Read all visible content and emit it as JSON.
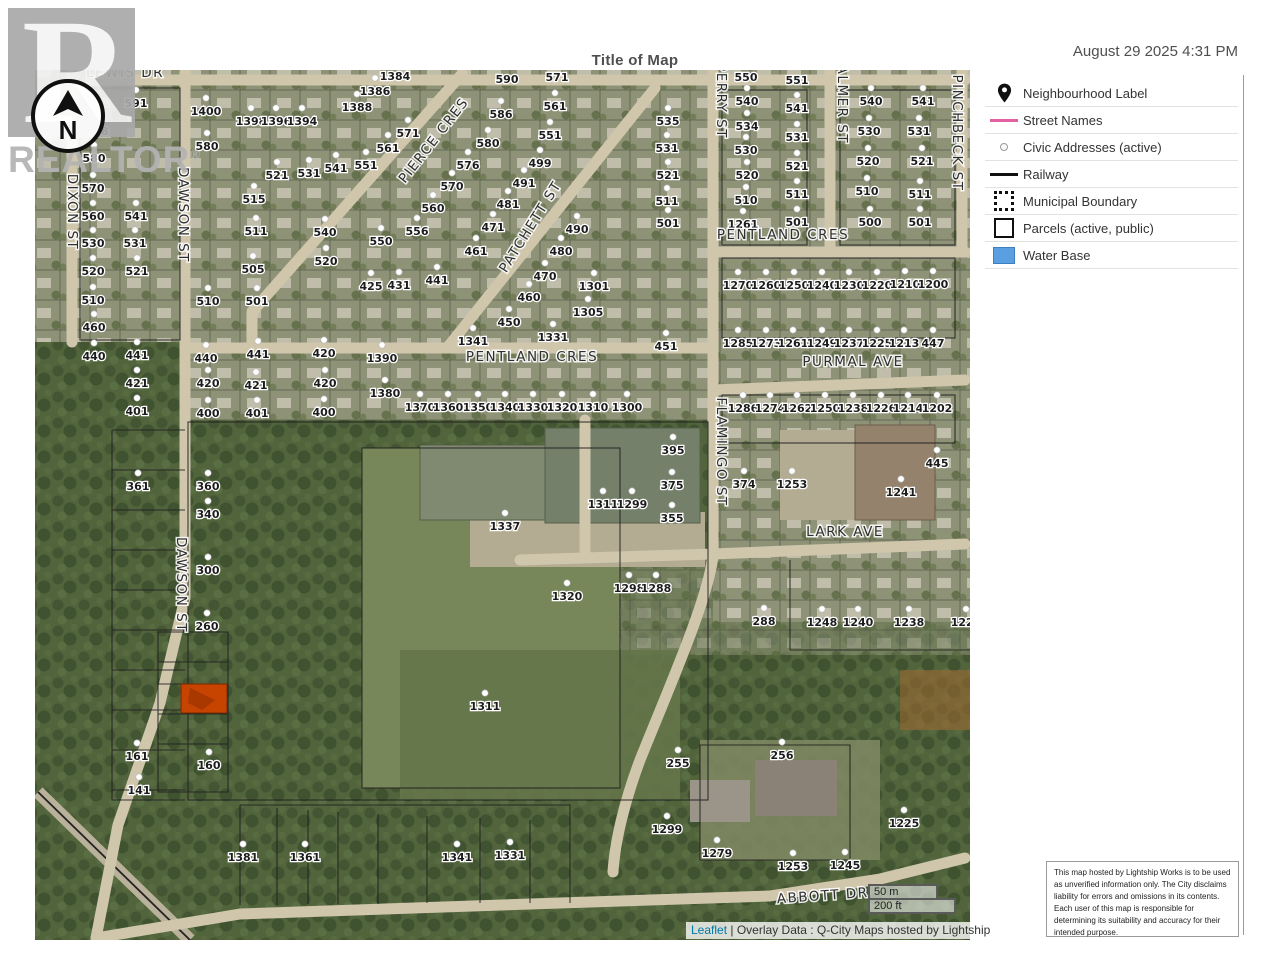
{
  "header": {
    "title": "Title of Map",
    "datetime": "August 29 2025 4:31 PM"
  },
  "branding": {
    "logo_letter": "R",
    "logo_text": "REALTOR",
    "logo_reg": "®",
    "compass_label": "N"
  },
  "legend": {
    "items": [
      {
        "icon": "map-pin-icon",
        "label": "Neighbourhood Label",
        "color": "#101010"
      },
      {
        "icon": "street-line-swatch",
        "label": "Street Names",
        "color": "#e361a2"
      },
      {
        "icon": "civic-address-dot-swatch",
        "label": "Civic Addresses (active)",
        "color": "#9a9a9a"
      },
      {
        "icon": "railway-line-swatch",
        "label": "Railway",
        "color": "#101010"
      },
      {
        "icon": "municipal-boundary-swatch",
        "label": "Municipal Boundary",
        "color": "#101010"
      },
      {
        "icon": "parcel-swatch",
        "label": "Parcels (active, public)",
        "color": "#ffffff"
      },
      {
        "icon": "water-swatch",
        "label": "Water Base",
        "color": "#5b9fe3"
      }
    ]
  },
  "scalebar": {
    "metric": "50 m",
    "imperial": "200 ft"
  },
  "attribution": {
    "leaflet": "Leaflet",
    "separator": "|",
    "overlay": "Overlay Data : Q-City Maps hosted by Lightship"
  },
  "disclaimer": {
    "text": "This map hosted by Lightship Works is to be used as unverified information only. The City disclaims liability for errors and omissions in its contents. Each user of this map is responsible for determining its suitability and accuracy for their intended purpose."
  },
  "map": {
    "colors": {
      "road": "#cfc6ac",
      "forest": "#51643c",
      "residential": "#8e9377",
      "highlight": "#c64300"
    },
    "highlight_parcel": {
      "x": 181,
      "y": 684,
      "width": 46,
      "height": 29,
      "color": "#c64300"
    },
    "streets": [
      [
        "LEWIS DR",
        125,
        77,
        0
      ],
      [
        "DIXON ST",
        68,
        212,
        90
      ],
      [
        "DAWSON ST",
        179,
        215,
        90
      ],
      [
        "DAWSON ST",
        177,
        585,
        90
      ],
      [
        "PIERCE CRES",
        437,
        143,
        -52
      ],
      [
        "PATCHETT ST",
        534,
        229,
        -58
      ],
      [
        "PERRY ST",
        717,
        101,
        90
      ],
      [
        "PALMER ST",
        838,
        100,
        90
      ],
      [
        "PINCHBECK ST",
        953,
        133,
        90
      ],
      [
        "PENTLAND CRES",
        783,
        239,
        0
      ],
      [
        "PENTLAND CRES",
        532,
        361,
        0
      ],
      [
        "PURMAL AVE",
        853,
        366,
        0
      ],
      [
        "FLAMINGO ST",
        717,
        452,
        90
      ],
      [
        "LARK AVE",
        845,
        536,
        0
      ],
      [
        "ABBOTT DR",
        823,
        900,
        -4
      ]
    ],
    "addresses": [
      [
        "591",
        136,
        103
      ],
      [
        "588",
        97,
        131
      ],
      [
        "580",
        94,
        158
      ],
      [
        "570",
        93,
        188
      ],
      [
        "560",
        93,
        216
      ],
      [
        "541",
        136,
        216
      ],
      [
        "530",
        93,
        243
      ],
      [
        "531",
        135,
        243
      ],
      [
        "520",
        93,
        271
      ],
      [
        "521",
        137,
        271
      ],
      [
        "510",
        93,
        300
      ],
      [
        "460",
        94,
        327
      ],
      [
        "440",
        94,
        356
      ],
      [
        "441",
        137,
        355
      ],
      [
        "421",
        137,
        383
      ],
      [
        "401",
        137,
        411
      ],
      [
        "1400",
        206,
        111
      ],
      [
        "580",
        207,
        146
      ],
      [
        "510",
        208,
        301
      ],
      [
        "505",
        253,
        269
      ],
      [
        "501",
        257,
        301
      ],
      [
        "511",
        256,
        231
      ],
      [
        "515",
        254,
        199
      ],
      [
        "521",
        277,
        175
      ],
      [
        "531",
        309,
        173
      ],
      [
        "541",
        336,
        168
      ],
      [
        "540",
        325,
        232
      ],
      [
        "520",
        326,
        261
      ],
      [
        "1398",
        251,
        121
      ],
      [
        "1396",
        276,
        121
      ],
      [
        "1394",
        302,
        121
      ],
      [
        "1384",
        395,
        76
      ],
      [
        "1386",
        375,
        91
      ],
      [
        "1388",
        357,
        107
      ],
      [
        "571",
        408,
        133
      ],
      [
        "561",
        388,
        148
      ],
      [
        "551",
        366,
        165
      ],
      [
        "590",
        507,
        79
      ],
      [
        "586",
        501,
        114
      ],
      [
        "580",
        488,
        143
      ],
      [
        "576",
        468,
        165
      ],
      [
        "570",
        452,
        186
      ],
      [
        "560",
        433,
        208
      ],
      [
        "556",
        417,
        231
      ],
      [
        "550",
        381,
        241
      ],
      [
        "425",
        371,
        286
      ],
      [
        "431",
        399,
        285
      ],
      [
        "441",
        437,
        280
      ],
      [
        "461",
        476,
        251
      ],
      [
        "471",
        493,
        227
      ],
      [
        "481",
        508,
        204
      ],
      [
        "491",
        524,
        183
      ],
      [
        "499",
        540,
        163
      ],
      [
        "571",
        557,
        77
      ],
      [
        "561",
        555,
        106
      ],
      [
        "551",
        550,
        135
      ],
      [
        "490",
        577,
        229
      ],
      [
        "480",
        561,
        251
      ],
      [
        "470",
        545,
        276
      ],
      [
        "460",
        529,
        297
      ],
      [
        "450",
        509,
        322
      ],
      [
        "1301",
        594,
        286
      ],
      [
        "1305",
        588,
        312
      ],
      [
        "1331",
        553,
        337
      ],
      [
        "1341",
        473,
        341
      ],
      [
        "535",
        668,
        121
      ],
      [
        "531",
        667,
        148
      ],
      [
        "521",
        668,
        175
      ],
      [
        "511",
        667,
        201
      ],
      [
        "501",
        668,
        223
      ],
      [
        "550",
        746,
        77
      ],
      [
        "540",
        747,
        101
      ],
      [
        "534",
        747,
        126
      ],
      [
        "530",
        746,
        150
      ],
      [
        "520",
        747,
        175
      ],
      [
        "510",
        746,
        200
      ],
      [
        "1261",
        743,
        224
      ],
      [
        "551",
        797,
        80
      ],
      [
        "541",
        797,
        108
      ],
      [
        "531",
        797,
        137
      ],
      [
        "521",
        797,
        166
      ],
      [
        "511",
        797,
        194
      ],
      [
        "501",
        797,
        222
      ],
      [
        "540",
        871,
        101
      ],
      [
        "530",
        869,
        131
      ],
      [
        "520",
        868,
        161
      ],
      [
        "510",
        867,
        191
      ],
      [
        "500",
        870,
        222
      ],
      [
        "541",
        923,
        101
      ],
      [
        "531",
        919,
        131
      ],
      [
        "521",
        922,
        161
      ],
      [
        "511",
        920,
        194
      ],
      [
        "501",
        920,
        222
      ],
      [
        "1270",
        738,
        285
      ],
      [
        "1260",
        766,
        285
      ],
      [
        "1250",
        794,
        285
      ],
      [
        "1240",
        822,
        285
      ],
      [
        "1230",
        849,
        285
      ],
      [
        "1220",
        877,
        285
      ],
      [
        "1210",
        905,
        284
      ],
      [
        "1200",
        933,
        284
      ],
      [
        "1285",
        738,
        343
      ],
      [
        "1273",
        766,
        343
      ],
      [
        "1261",
        793,
        343
      ],
      [
        "1249",
        822,
        343
      ],
      [
        "1237",
        849,
        343
      ],
      [
        "1225",
        877,
        343
      ],
      [
        "1213",
        904,
        343
      ],
      [
        "447",
        933,
        343
      ],
      [
        "451",
        666,
        346
      ],
      [
        "1286",
        743,
        408
      ],
      [
        "1274",
        770,
        408
      ],
      [
        "1262",
        797,
        408
      ],
      [
        "1250",
        825,
        408
      ],
      [
        "1238",
        853,
        408
      ],
      [
        "1226",
        881,
        408
      ],
      [
        "1214",
        908,
        408
      ],
      [
        "1202",
        937,
        408
      ],
      [
        "395",
        673,
        450
      ],
      [
        "375",
        672,
        485
      ],
      [
        "355",
        672,
        518
      ],
      [
        "374",
        744,
        484
      ],
      [
        "1253",
        792,
        484
      ],
      [
        "1241",
        901,
        492
      ],
      [
        "445",
        937,
        463
      ],
      [
        "1390",
        382,
        358
      ],
      [
        "1380",
        385,
        393
      ],
      [
        "1370",
        420,
        407
      ],
      [
        "1360",
        448,
        407
      ],
      [
        "1350",
        478,
        407
      ],
      [
        "1340",
        505,
        407
      ],
      [
        "1330",
        533,
        407
      ],
      [
        "1320",
        562,
        407
      ],
      [
        "1310",
        593,
        407
      ],
      [
        "1300",
        627,
        407
      ],
      [
        "440",
        206,
        358
      ],
      [
        "420",
        208,
        383
      ],
      [
        "400",
        208,
        413
      ],
      [
        "441",
        258,
        354
      ],
      [
        "421",
        256,
        385
      ],
      [
        "401",
        257,
        413
      ],
      [
        "420",
        324,
        353
      ],
      [
        "420",
        325,
        383
      ],
      [
        "400",
        324,
        412
      ],
      [
        "1337",
        505,
        526
      ],
      [
        "1311",
        603,
        504
      ],
      [
        "1299",
        632,
        504
      ],
      [
        "361",
        138,
        486
      ],
      [
        "360",
        208,
        486
      ],
      [
        "340",
        208,
        514
      ],
      [
        "300",
        208,
        570
      ],
      [
        "260",
        207,
        626
      ],
      [
        "161",
        137,
        756
      ],
      [
        "160",
        209,
        765
      ],
      [
        "141",
        139,
        790
      ],
      [
        "1320",
        567,
        596
      ],
      [
        "1298",
        629,
        588
      ],
      [
        "1288",
        656,
        588
      ],
      [
        "288",
        764,
        621
      ],
      [
        "1248",
        822,
        622
      ],
      [
        "1240",
        858,
        622
      ],
      [
        "1238",
        909,
        622
      ],
      [
        "1228",
        966,
        622
      ],
      [
        "1311",
        485,
        706
      ],
      [
        "255",
        678,
        763
      ],
      [
        "256",
        782,
        755
      ],
      [
        "1299",
        667,
        829
      ],
      [
        "1279",
        717,
        853
      ],
      [
        "1253",
        793,
        866
      ],
      [
        "1245",
        845,
        865
      ],
      [
        "1225",
        904,
        823
      ],
      [
        "1381",
        243,
        857
      ],
      [
        "1361",
        305,
        857
      ],
      [
        "1341",
        457,
        857
      ],
      [
        "1331",
        510,
        855
      ]
    ]
  }
}
